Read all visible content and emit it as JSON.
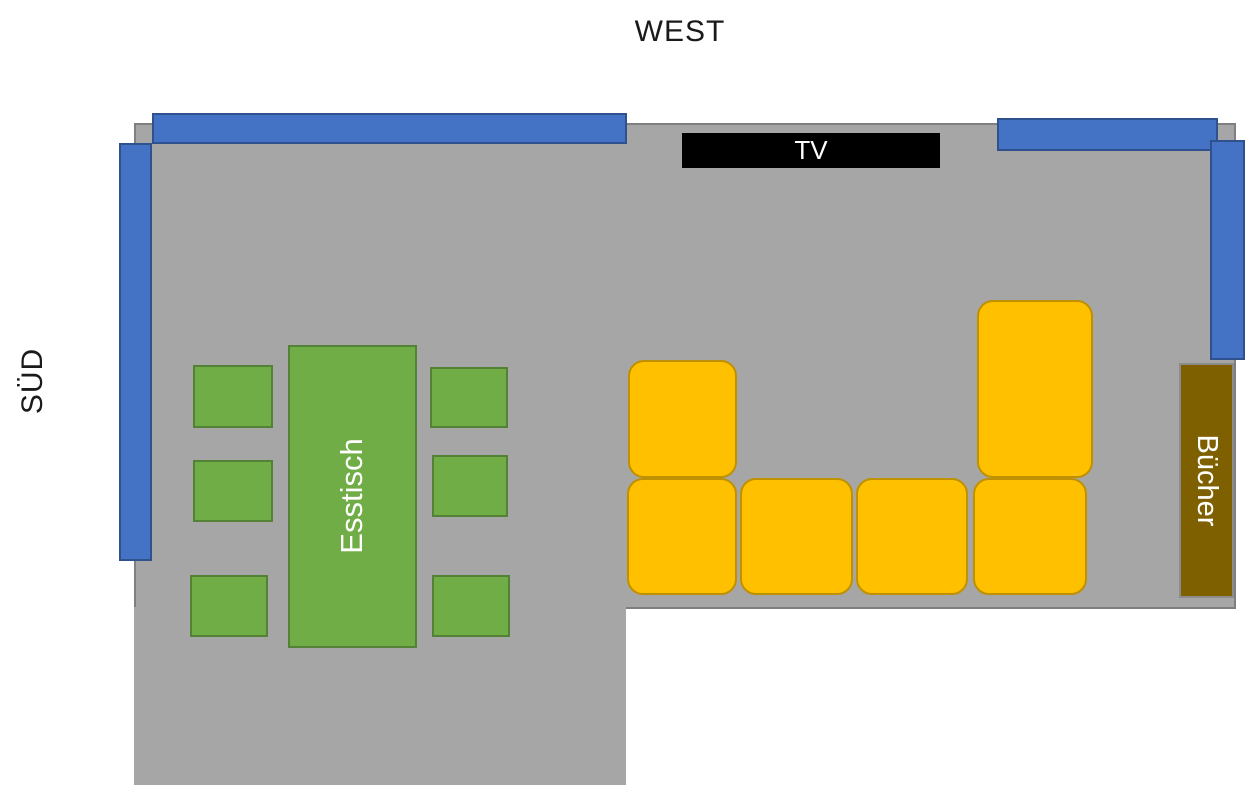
{
  "diagram": {
    "type": "floor-plan",
    "compass_labels": {
      "west": "WEST",
      "south": "SÜD"
    },
    "room": {
      "name": "living-dining-room",
      "shape": "L-shaped",
      "floor_color": "#A6A6A6",
      "outline_color": "#7F7F7F"
    },
    "windows": {
      "count": 4,
      "color": "#4472C4",
      "border_color": "#2F528F",
      "positions": [
        "top-left-wall",
        "top-right-wall",
        "right-wall",
        "left-wall"
      ]
    },
    "tv": {
      "label": "TV",
      "color": "#000000",
      "text_color": "#FFFFFF"
    },
    "dining": {
      "table_label": "Esstisch",
      "color": "#70AD47",
      "border_color": "#538135",
      "chair_count": 6
    },
    "sofa": {
      "color": "#FFC000",
      "border_color": "#BF9000",
      "piece_count": 6,
      "arrangement": "U-shaped: 4 seats in a row, one back piece left, one tall back piece right"
    },
    "bookshelf": {
      "label": "Bücher",
      "color": "#7F6000",
      "border_color": "#8C8C8C",
      "text_color": "#FFFFFF"
    }
  }
}
